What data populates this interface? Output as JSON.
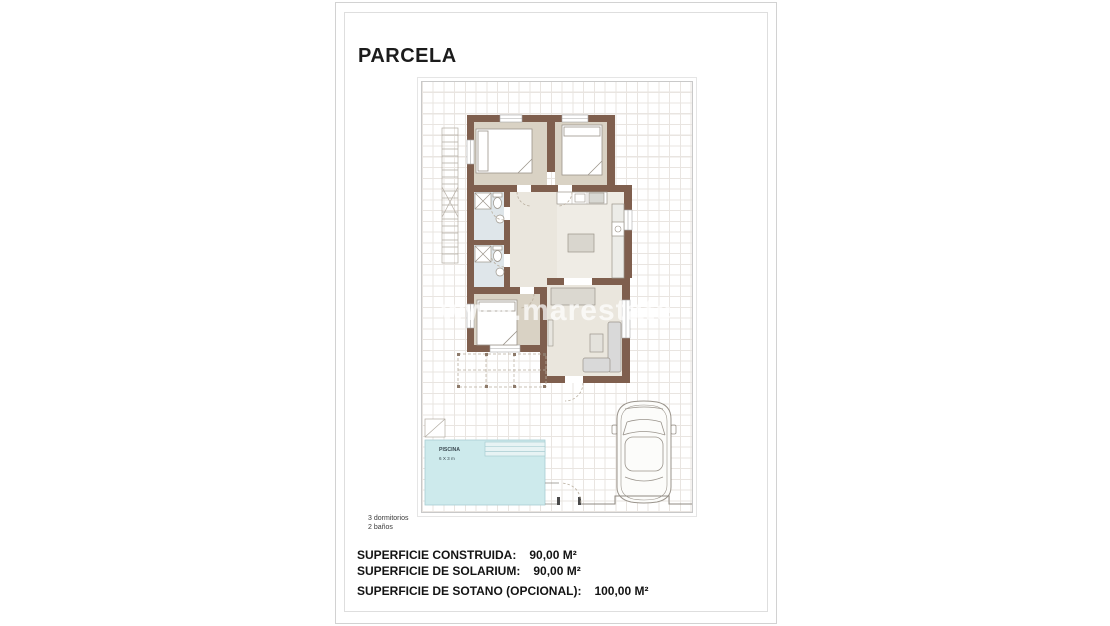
{
  "document": {
    "title": "PARCELA",
    "notes": [
      "3 dormitorios",
      "2 baños"
    ],
    "surfaces": [
      {
        "label": "SUPERFICIE CONSTRUIDA:",
        "value": "90,00 M²"
      },
      {
        "label": "SUPERFICIE DE SOLARIUM:",
        "value": "90,00 M²"
      },
      {
        "label": "SUPERFICIE DE SOTANO (OPCIONAL):",
        "value": "100,00 M²"
      }
    ]
  },
  "plan": {
    "watermark": "www.marestate",
    "pool": {
      "label": "PISCINA",
      "size": "6 X 3 m"
    },
    "colors": {
      "wall": "#7f5f4e",
      "room": "#d9d2c4",
      "hall": "#eae6dd",
      "kitchen": "#efece5",
      "bath": "#dfe6ea",
      "pool": "#cdeaec",
      "grid": "#e9e5e1",
      "line": "#9b948a",
      "dash": "#b9ae9e",
      "fence": "#8f8a82"
    }
  }
}
